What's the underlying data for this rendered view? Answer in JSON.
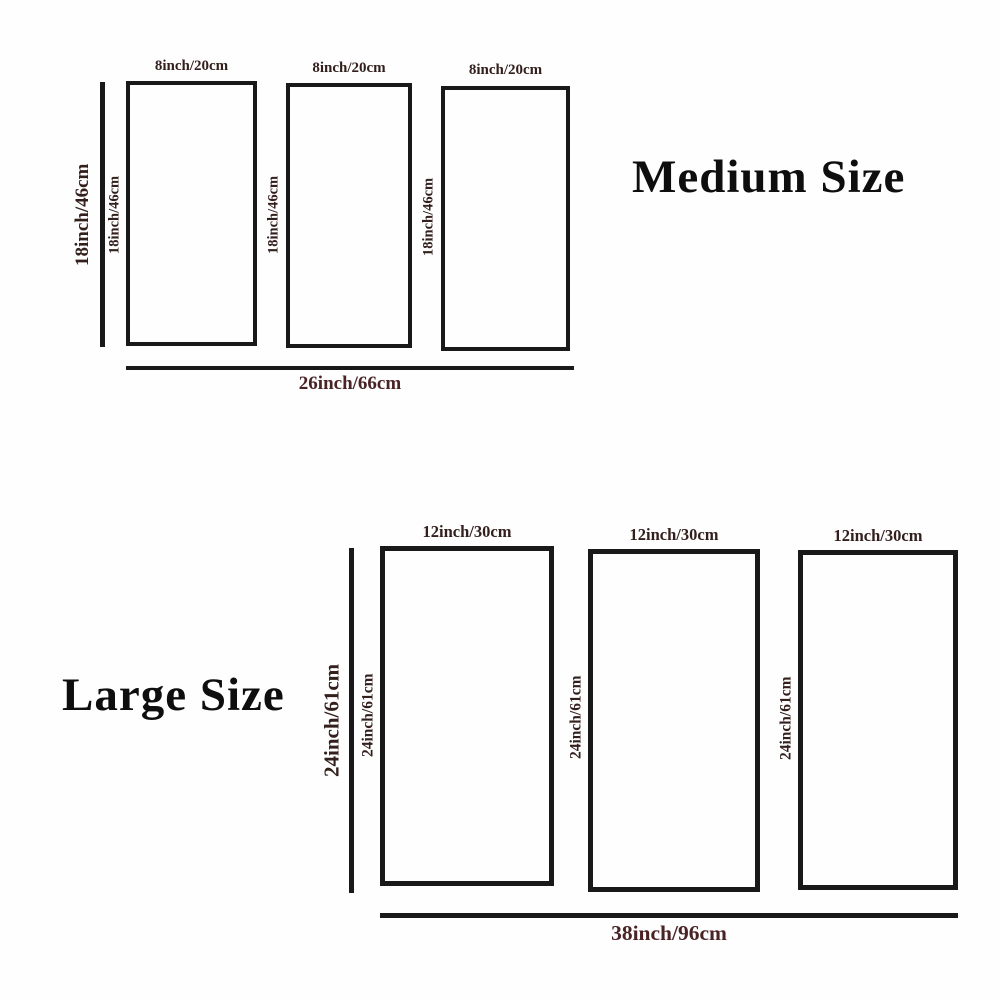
{
  "diagram": {
    "description": "Three-panel product size chart",
    "colors": {
      "background": "#fefefe",
      "outline": "#191919",
      "dimension_label": "#33201d",
      "total_label": "#4a2325",
      "title": "#0e0e0e"
    },
    "sections": {
      "medium": {
        "title": "Medium Size",
        "overall_height_label": "18inch/46cm",
        "overall_width_label": "26inch/66cm",
        "panels": [
          {
            "width_label": "8inch/20cm",
            "height_label": "18inch/46cm"
          },
          {
            "width_label": "8inch/20cm",
            "height_label": "18inch/46cm"
          },
          {
            "width_label": "8inch/20cm",
            "height_label": "18inch/46cm"
          }
        ]
      },
      "large": {
        "title": "Large Size",
        "overall_height_label": "24inch/61cm",
        "overall_width_label": "38inch/96cm",
        "panels": [
          {
            "width_label": "12inch/30cm",
            "height_label": "24inch/61cm"
          },
          {
            "width_label": "12inch/30cm",
            "height_label": "24inch/61cm"
          },
          {
            "width_label": "12inch/30cm",
            "height_label": "24inch/61cm"
          }
        ]
      }
    }
  }
}
